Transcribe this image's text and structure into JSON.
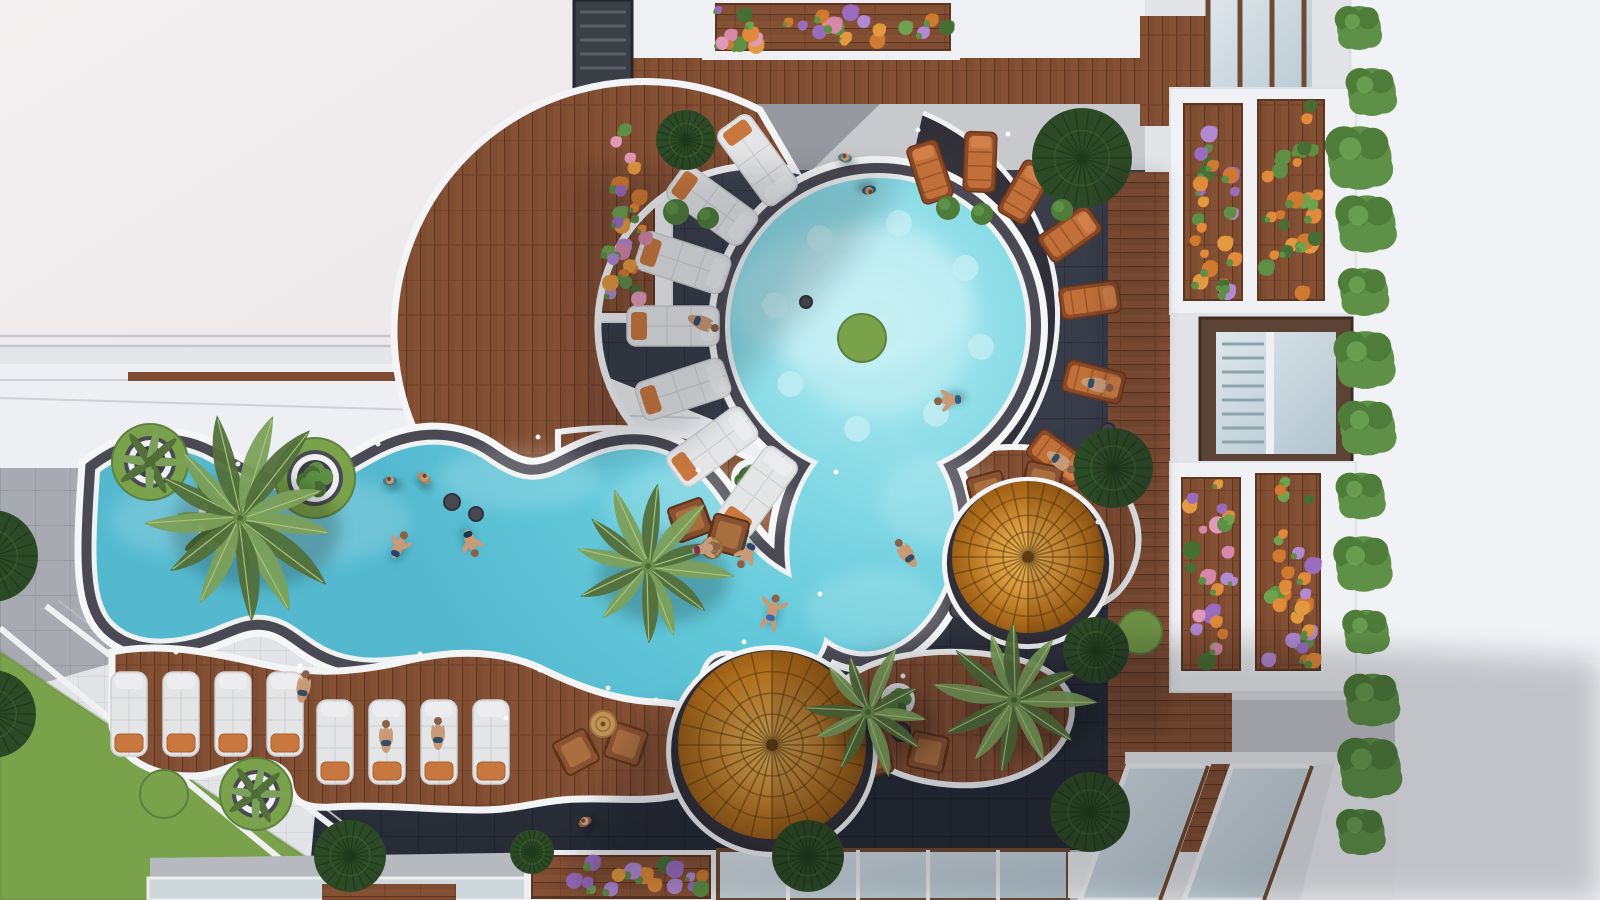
{
  "scene": {
    "description": "aerial-top-down-render-of-resort-courtyard-with-organic-pool",
    "palette": {
      "roof_white": "#f2eef0",
      "ledge_white": "#eaecef",
      "wall_white": "#f1f2f6",
      "dark_tile": "#363b47",
      "dark_tile_line": "#2b303c",
      "gray_paver": "#a7abb1",
      "white_tile": "#e3e4e7",
      "concrete": "#b6b9bd",
      "wood": "#7e4c31",
      "wood_line": "#5d3520",
      "wood_light": "#8a5638",
      "water_light": "#aee8ef",
      "water_mid": "#7fd8e4",
      "water_deep": "#54b9cf",
      "pool_curb_white": "#f4f6f7",
      "pool_stone": "#4b4a54",
      "grass": "#7aa24b",
      "grass_dark": "#5c8040",
      "canopy_green": "#2d4a26",
      "palm_green": "#7ba05a",
      "palm_dark": "#52703a",
      "palm_light": "#a8c27c",
      "lounger_white": "#e4e5e7",
      "cushion_orange": "#c8783e",
      "flat_lounger_wood": "#8a4a28",
      "flat_lounger_pad": "#c07038",
      "umbrella_amber_hi": "#e8b959",
      "umbrella_amber_lo": "#9c5f16",
      "flower_orange": "#e08a3a",
      "flower_purple": "#9a6cc0",
      "flower_pink": "#d787a8",
      "leaf_green": "#5d8f44",
      "glass": "#ccd9e0",
      "skin": "#c89a78"
    },
    "objects": {
      "palms": [
        [
          240,
          518,
          105,
          13
        ],
        [
          648,
          566,
          82,
          12
        ],
        [
          868,
          712,
          66,
          10
        ],
        [
          1014,
          700,
          80,
          12
        ]
      ],
      "canopy_trees": [
        [
          1082,
          158,
          50
        ],
        [
          1113,
          468,
          40
        ],
        [
          1096,
          650,
          33
        ],
        [
          1090,
          812,
          40
        ],
        [
          808,
          856,
          36
        ],
        [
          686,
          140,
          30
        ],
        [
          -8,
          556,
          46
        ],
        [
          -8,
          714,
          44
        ],
        [
          350,
          856,
          36
        ],
        [
          532,
          852,
          22
        ]
      ],
      "grass_circles": [
        [
          164,
          794,
          24
        ],
        [
          1140,
          632,
          22
        ],
        [
          862,
          338,
          24
        ]
      ],
      "ring_planters": [
        [
          150,
          462,
          22
        ],
        [
          315,
          478,
          24
        ],
        [
          256,
          794,
          20
        ]
      ],
      "white_planters": [
        [
          227,
          522,
          30
        ],
        [
          750,
          478,
          19
        ],
        [
          898,
          700,
          17
        ]
      ],
      "umbrellas": [
        [
          1028,
          557,
          76
        ],
        [
          772,
          745,
          94
        ]
      ],
      "white_loungers": [
        [
          128,
          712
        ],
        [
          180,
          712
        ],
        [
          232,
          712
        ],
        [
          284,
          712
        ],
        [
          334,
          740
        ],
        [
          386,
          740
        ],
        [
          438,
          740
        ],
        [
          490,
          740
        ]
      ],
      "flat_loungers": [
        [
          930,
          172,
          -18
        ],
        [
          980,
          162,
          2
        ],
        [
          1025,
          192,
          30
        ],
        [
          1070,
          234,
          55
        ],
        [
          1090,
          300,
          82
        ],
        [
          1094,
          382,
          104
        ],
        [
          1058,
          458,
          126
        ]
      ],
      "deck_pads": {
        "cx": 878,
        "cy": 326,
        "r": 205,
        "angles": [
          126,
          144,
          162,
          180,
          198,
          216,
          234
        ]
      },
      "pool_seats": {
        "cx": 878,
        "cy": 326,
        "r": 105,
        "count": 8,
        "size": 13
      },
      "wood_chairs": [
        [
          576,
          752,
          -28
        ],
        [
          626,
          744,
          18
        ],
        [
          988,
          492,
          -15
        ],
        [
          1042,
          482,
          12
        ],
        [
          872,
          758,
          -15
        ],
        [
          928,
          752,
          12
        ],
        [
          690,
          520,
          -20
        ],
        [
          728,
          535,
          15
        ]
      ],
      "rattan_tables": [
        [
          603,
          724,
          13
        ],
        [
          712,
          548,
          10
        ]
      ],
      "dark_tables": [
        [
          1016,
          524,
          15
        ],
        [
          901,
          732,
          9
        ]
      ],
      "stools": [
        [
          452,
          502,
          8
        ],
        [
          476,
          514,
          7
        ],
        [
          806,
          302,
          6
        ],
        [
          958,
          610,
          8
        ],
        [
          1108,
          430,
          7
        ]
      ],
      "hedge_column": {
        "x": 1366,
        "ys": [
          28,
          92,
          158,
          224,
          292,
          360,
          428,
          496,
          564,
          632,
          700,
          768,
          832
        ]
      },
      "small_bushes": [
        [
          676,
          212,
          13
        ],
        [
          708,
          218,
          11
        ],
        [
          948,
          208,
          12
        ],
        [
          982,
          214,
          11
        ],
        [
          1062,
          210,
          11
        ]
      ],
      "flower_boxes": [
        [
          712,
          4,
          242,
          48,
          [
            "purple",
            "orange",
            "green",
            "orange",
            "pink"
          ]
        ],
        [
          596,
          110,
          56,
          200,
          [
            "green",
            "purple",
            "pink",
            "orange",
            "orange"
          ]
        ],
        [
          1184,
          104,
          58,
          196,
          [
            "orange",
            "green",
            "purple",
            "orange"
          ]
        ],
        [
          1258,
          100,
          66,
          200,
          [
            "orange",
            "green",
            "orange",
            "green"
          ]
        ],
        [
          1182,
          478,
          58,
          192,
          [
            "orange",
            "purple",
            "green",
            "pink"
          ]
        ],
        [
          1256,
          474,
          64,
          196,
          [
            "green",
            "orange",
            "purple",
            "orange"
          ]
        ],
        [
          532,
          856,
          178,
          42,
          [
            "purple",
            "orange",
            "green",
            "purple"
          ]
        ]
      ],
      "people": [
        {
          "x": 398,
          "y": 548,
          "pose": "swim",
          "rot": 25,
          "suit": "#26446e"
        },
        {
          "x": 470,
          "y": 540,
          "pose": "swim",
          "rot": 160,
          "suit": "#173a4d"
        },
        {
          "x": 703,
          "y": 549,
          "pose": "swim",
          "rot": 80,
          "suit": "#7e3348"
        },
        {
          "x": 748,
          "y": 552,
          "pose": "swim",
          "rot": 210,
          "suit": "#26446e"
        },
        {
          "x": 952,
          "y": 400,
          "pose": "swim",
          "rot": -95,
          "suit": "#2d5f86"
        },
        {
          "x": 772,
          "y": 612,
          "pose": "float",
          "rot": 15,
          "suit": "#3a66b0"
        },
        {
          "x": 845,
          "y": 158,
          "pose": "stand",
          "rot": 10,
          "shirt": "#4d7f8e"
        },
        {
          "x": 869,
          "y": 190,
          "pose": "stand",
          "rot": 170,
          "shirt": "#35556e"
        },
        {
          "x": 390,
          "y": 481,
          "pose": "stand",
          "rot": 0,
          "shirt": "#46788a"
        },
        {
          "x": 424,
          "y": 478,
          "pose": "stand",
          "rot": 40,
          "shirt": "#b98354"
        },
        {
          "x": 585,
          "y": 822,
          "pose": "walk",
          "rot": -30,
          "shirt": "#8a5a40"
        },
        {
          "x": 303,
          "y": 690,
          "pose": "lie",
          "rot": 10
        },
        {
          "x": 386,
          "y": 740,
          "pose": "lie",
          "rot": 0
        },
        {
          "x": 438,
          "y": 737,
          "pose": "lie",
          "rot": 0
        },
        {
          "x": 700,
          "y": 322,
          "pose": "lie",
          "rot": 112
        },
        {
          "x": 908,
          "y": 556,
          "pose": "lie",
          "rot": -35
        },
        {
          "x": 1094,
          "y": 384,
          "pose": "lie",
          "rot": 104
        },
        {
          "x": 1058,
          "y": 460,
          "pose": "lie",
          "rot": 126
        }
      ],
      "edge_lights": [
        [
          176,
          652
        ],
        [
          300,
          666
        ],
        [
          420,
          654
        ],
        [
          540,
          670
        ],
        [
          656,
          700
        ],
        [
          836,
          472
        ],
        [
          918,
          130
        ],
        [
          1008,
          134
        ],
        [
          820,
          594
        ],
        [
          698,
          470
        ],
        [
          538,
          437
        ],
        [
          378,
          444
        ],
        [
          238,
          464
        ],
        [
          1098,
          522
        ],
        [
          903,
          676
        ],
        [
          744,
          642
        ],
        [
          608,
          688
        ],
        [
          506,
          718
        ]
      ],
      "caustics": [
        [
          850,
          300,
          120,
          70
        ],
        [
          700,
          505,
          95,
          42
        ],
        [
          300,
          520,
          110,
          45
        ],
        [
          520,
          478,
          82,
          32
        ],
        [
          940,
          500,
          62,
          44
        ],
        [
          180,
          520,
          70,
          35
        ],
        [
          876,
          610,
          70,
          40
        ]
      ]
    }
  }
}
